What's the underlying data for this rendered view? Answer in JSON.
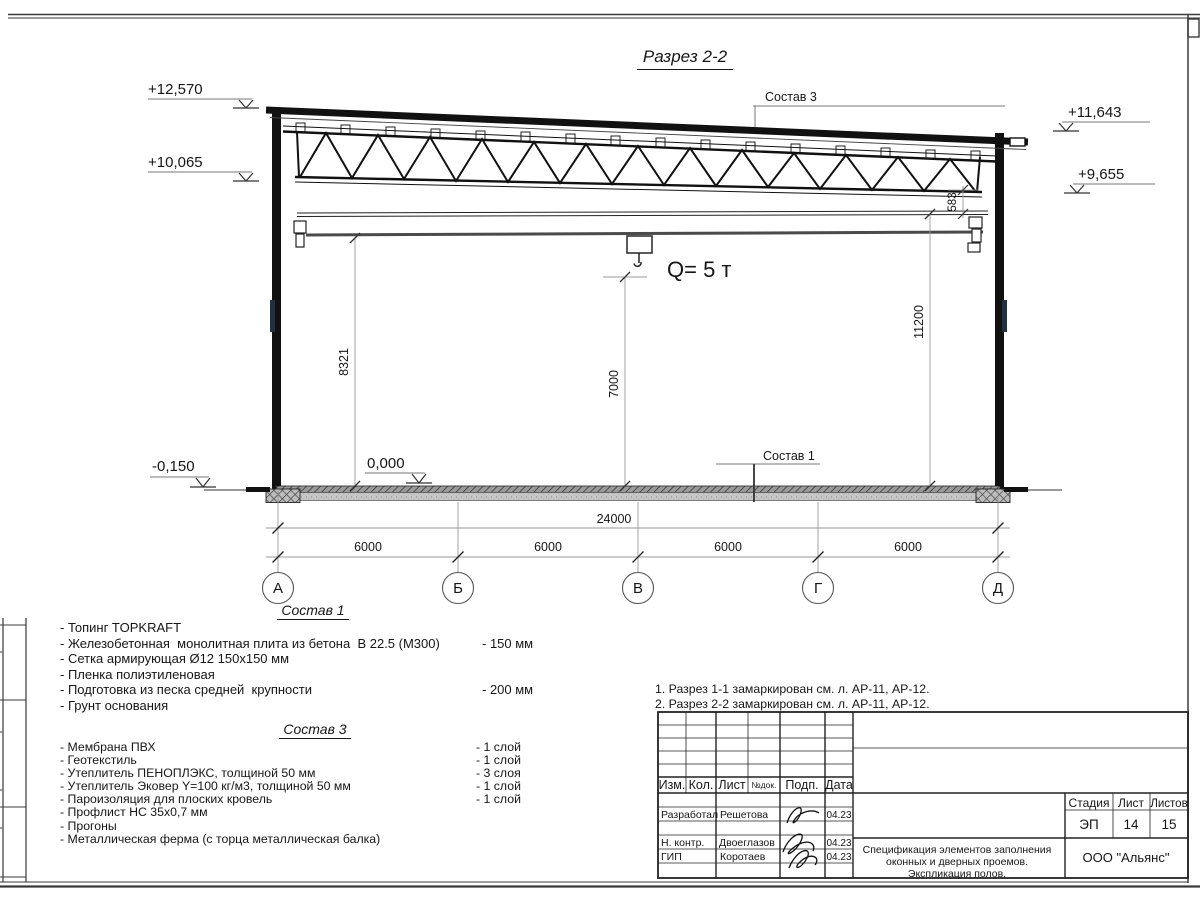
{
  "title": "Разрез 2-2",
  "crane_label": "Q= 5 т",
  "elevations": {
    "left_top": "+12,570",
    "left_mid": "+10,065",
    "right_top": "+11,643",
    "right_mid": "+9,655",
    "ground": "-0,150",
    "floor_zero": "0,000"
  },
  "dims": {
    "v_left": "8321",
    "v_center": "7000",
    "v_right": "11200",
    "truss_to_beam": "583",
    "total": "24000",
    "bays": [
      "6000",
      "6000",
      "6000",
      "6000"
    ]
  },
  "grid_axes": [
    "А",
    "Б",
    "В",
    "Г",
    "Д"
  ],
  "callouts": {
    "sostav3": "Состав 3",
    "sostav1": "Состав 1"
  },
  "sostav1": {
    "heading": "Состав 1",
    "items": [
      {
        "text": "- Топинг TOPKRAFT",
        "value": ""
      },
      {
        "text": "- Железобетонная  монолитная плита из бетона  В 22.5 (М300)",
        "value": "- 150 мм"
      },
      {
        "text": "- Сетка армирующая Ø12 150х150 мм",
        "value": ""
      },
      {
        "text": "- Пленка полиэтиленовая",
        "value": ""
      },
      {
        "text": "- Подготовка из песка средней  крупности",
        "value": "- 200 мм"
      },
      {
        "text": "- Грунт основания",
        "value": ""
      }
    ]
  },
  "sostav3": {
    "heading": "Состав 3",
    "items": [
      {
        "text": "- Мембрана ПВХ",
        "value": "- 1 слой"
      },
      {
        "text": "- Геотекстиль",
        "value": "- 1 слой"
      },
      {
        "text": "- Утеплитель ПЕНОПЛЭКС, толщиной 50 мм",
        "value": "- 3 слоя"
      },
      {
        "text": "- Утеплитель Эковер Y=100 кг/м3, толщиной 50 мм",
        "value": "- 1 слой"
      },
      {
        "text": "- Пароизоляция для плоских кровель",
        "value": "- 1 слой"
      },
      {
        "text": "- Профлист НС 35х0,7 мм",
        "value": ""
      },
      {
        "text": "- Прогоны",
        "value": ""
      },
      {
        "text": "- Металлическая ферма (с торца металлическая балка)",
        "value": ""
      }
    ]
  },
  "notes": [
    "1. Разрез 1-1 замаркирован см. л. АР-11, АР-12.",
    "2. Разрез 2-2 замаркирован см. л. АР-11, АР-12."
  ],
  "titleblock": {
    "header": {
      "izm": "Изм.",
      "kol": "Кол.",
      "list": "Лист",
      "ndok": "№док.",
      "podp": "Подп.",
      "data": "Дата"
    },
    "rows": [
      {
        "role": "Разработал",
        "name": "Решетова",
        "date": "04.23"
      },
      {
        "role": "Н. контр.",
        "name": "Двоеглазов",
        "date": "04.23"
      },
      {
        "role": "ГИП",
        "name": "Коротаев",
        "date": "04.23"
      }
    ],
    "stage_label": "Стадия",
    "sheet_label": "Лист",
    "sheets_label": "Листов",
    "stage": "ЭП",
    "sheet": "14",
    "sheets": "15",
    "doc_title_lines": [
      "Спецификация элементов заполнения",
      "оконных и дверных проемов.",
      "Экспликация полов."
    ],
    "company": "ООО \"Альянс\""
  },
  "colors": {
    "line": "#161616",
    "dim": "#8a8a8a",
    "floor_fill": "#c6c6c6",
    "crane": "#4a4a4a"
  }
}
